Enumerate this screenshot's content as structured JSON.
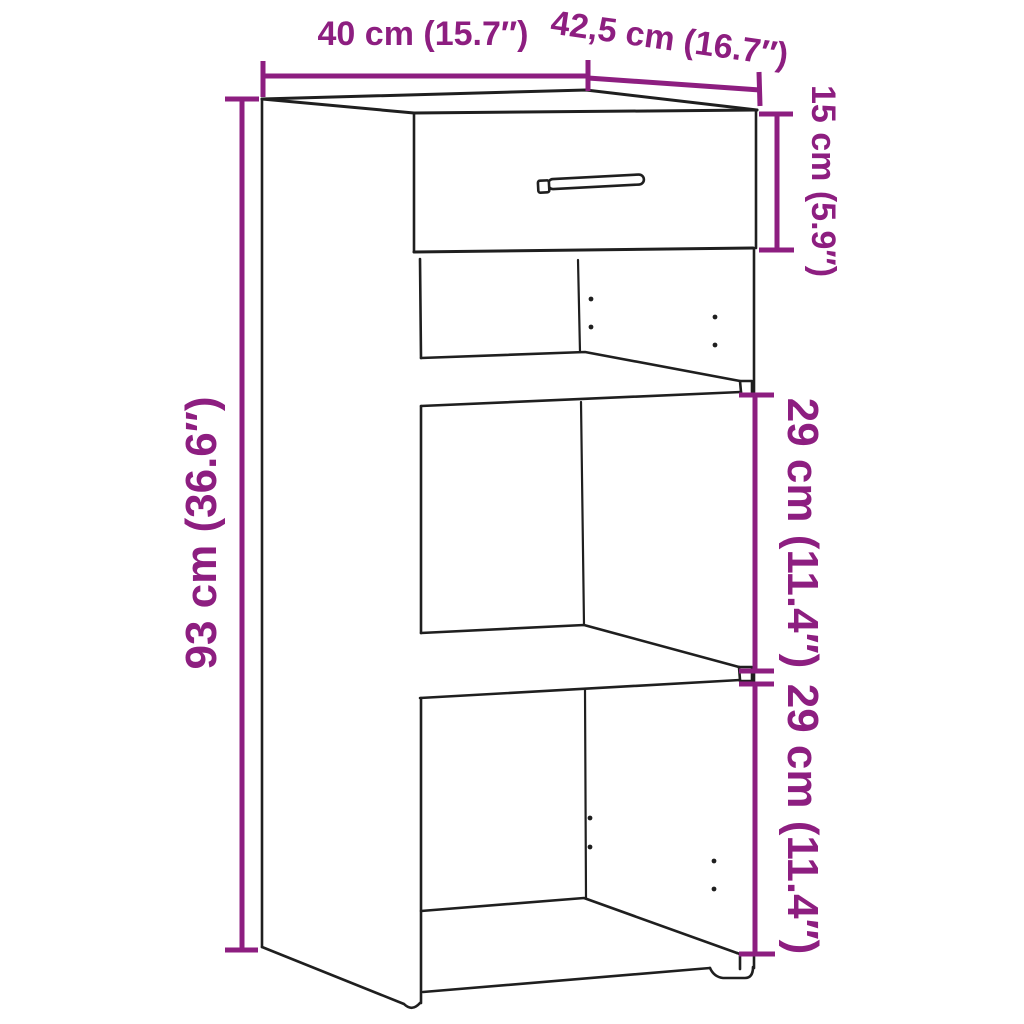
{
  "diagram": {
    "type": "furniture-dimension-diagram",
    "subject": "sideboard cabinet with one drawer and two open shelf compartments",
    "style": {
      "outline_color": "#1f1f1f",
      "dimension_color": "#8D1E80",
      "background": "#ffffff"
    },
    "dimensions": {
      "width": {
        "label": "40 cm (15.7″)",
        "cm": 40,
        "inches": 15.7,
        "measures": "overall width",
        "orientation": "horizontal-top"
      },
      "depth": {
        "label": "42,5 cm (16.7″)",
        "cm": 42.5,
        "inches": 16.7,
        "measures": "overall depth",
        "orientation": "diagonal-top-right"
      },
      "drawer_height": {
        "label": "15 cm (5.9″)",
        "cm": 15,
        "inches": 5.9,
        "measures": "drawer section height",
        "orientation": "vertical-right"
      },
      "total_height": {
        "label": "93 cm (36.6″)",
        "cm": 93,
        "inches": 36.6,
        "measures": "overall height",
        "orientation": "vertical-left"
      },
      "upper_compartment": {
        "label": "29 cm (11.4″)",
        "cm": 29,
        "inches": 11.4,
        "measures": "upper open compartment height",
        "orientation": "vertical-right"
      },
      "lower_compartment": {
        "label": "29 cm (11.4″)",
        "cm": 29,
        "inches": 11.4,
        "measures": "lower open compartment height",
        "orientation": "vertical-right"
      }
    }
  }
}
